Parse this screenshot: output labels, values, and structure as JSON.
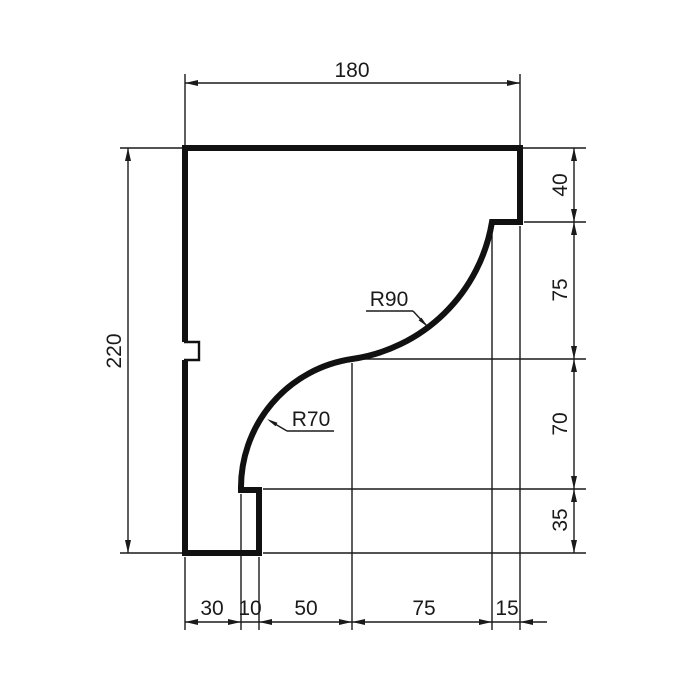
{
  "drawing": {
    "background_color": "#ffffff",
    "line_color": "#1a1a1a",
    "labels": {
      "width_total": "180",
      "height_total": "220",
      "right_top": "40",
      "right_upper": "75",
      "right_lower": "70",
      "right_bottom": "35",
      "bottom_1": "30",
      "bottom_2": "10",
      "bottom_3": "50",
      "bottom_4": "75",
      "bottom_5": "15",
      "radius_upper": "R90",
      "radius_lower": "R70"
    }
  }
}
